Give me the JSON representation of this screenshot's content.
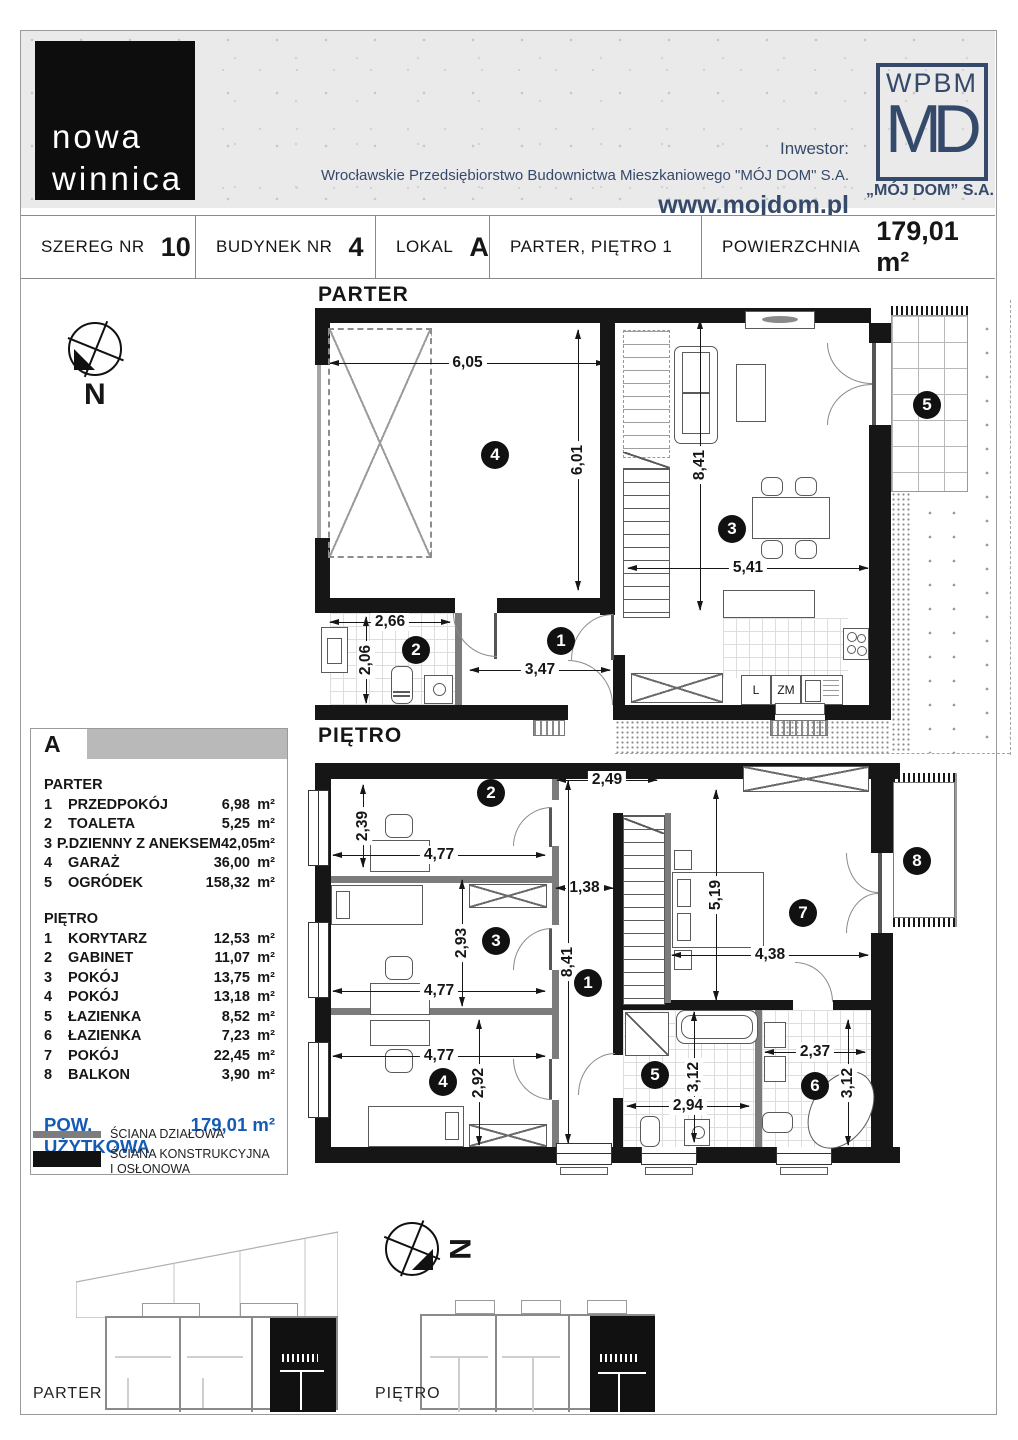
{
  "header": {
    "logo_line1": "nowa",
    "logo_line2": "winnica",
    "investor_label": "Inwestor:",
    "investor_company": "Wrocławskie Przedsiębiorstwo Budownictwa Mieszkaniowego \"MÓJ DOM\" S.A.",
    "website": "www.mojdom.pl",
    "brand_top": "WPBM",
    "brand_main": "MD",
    "brand_caption": "„MÓJ DOM” S.A."
  },
  "info_bar": {
    "cells": [
      {
        "label": "SZEREG NR",
        "value": "10"
      },
      {
        "label": "BUDYNEK NR",
        "value": "4"
      },
      {
        "label": "LOKAL",
        "value": "A"
      },
      {
        "label": "PARTER, PIĘTRO 1",
        "value": ""
      },
      {
        "label": "POWIERZCHNIA",
        "value": "179,01 m²"
      }
    ]
  },
  "compass": {
    "north": "N"
  },
  "plans": {
    "parter": {
      "title": "PARTER",
      "badges": [
        "1",
        "2",
        "3",
        "4",
        "5"
      ],
      "dims": {
        "garage_w": "6,05",
        "garage_h": "6,01",
        "living_h": "8,41",
        "living_w": "5,41",
        "toilet_w": "2,66",
        "toilet_h": "2,06",
        "hall_w": "3,47"
      },
      "kitchen": {
        "fridge": "L",
        "dishwasher": "ZM"
      }
    },
    "pietro": {
      "title": "PIĘTRO",
      "badges": [
        "1",
        "2",
        "3",
        "4",
        "5",
        "6",
        "7",
        "8"
      ],
      "dims": {
        "gabinet_h": "2,39",
        "gabinet_w": "4,77",
        "corridor_top_w": "2,49",
        "corridor_mid_w": "1,38",
        "corridor_h": "8,41",
        "room3_h": "2,93",
        "room3_w": "4,77",
        "room4_w": "4,77",
        "room4_h": "2,92",
        "room7_h": "5,19",
        "room7_w": "4,38",
        "bath5_h": "3,12",
        "bath5_w": "2,94",
        "bath6_w": "2,37",
        "bath6_h": "3,12"
      }
    }
  },
  "legend": {
    "unit": "A",
    "sections": [
      {
        "title": "PARTER",
        "rows": [
          {
            "no": "1",
            "name": "PRZEDPOKÓJ",
            "area": "6,98",
            "unit": "m²"
          },
          {
            "no": "2",
            "name": "TOALETA",
            "area": "5,25",
            "unit": "m²"
          },
          {
            "no": "3",
            "name": "P.DZIENNY Z ANEKSEM",
            "area": "42,05",
            "unit": "m²"
          },
          {
            "no": "4",
            "name": "GARAŻ",
            "area": "36,00",
            "unit": "m²"
          },
          {
            "no": "5",
            "name": "OGRÓDEK",
            "area": "158,32",
            "unit": "m²"
          }
        ]
      },
      {
        "title": "PIĘTRO",
        "rows": [
          {
            "no": "1",
            "name": "KORYTARZ",
            "area": "12,53",
            "unit": "m²"
          },
          {
            "no": "2",
            "name": "GABINET",
            "area": "11,07",
            "unit": "m²"
          },
          {
            "no": "3",
            "name": "POKÓJ",
            "area": "13,75",
            "unit": "m²"
          },
          {
            "no": "4",
            "name": "POKÓJ",
            "area": "13,18",
            "unit": "m²"
          },
          {
            "no": "5",
            "name": "ŁAZIENKA",
            "area": "8,52",
            "unit": "m²"
          },
          {
            "no": "6",
            "name": "ŁAZIENKA",
            "area": "7,23",
            "unit": "m²"
          },
          {
            "no": "7",
            "name": "POKÓJ",
            "area": "22,45",
            "unit": "m²"
          },
          {
            "no": "8",
            "name": "BALKON",
            "area": "3,90",
            "unit": "m²"
          }
        ]
      }
    ],
    "total_label": "POW. UŻYTKOWA",
    "total_value": "179,01 m²",
    "wall_legend": [
      {
        "label": "ŚCIANA DZIAŁOWA"
      },
      {
        "label": "ŚCIANA KONSTRUKCYJNA I OSŁONOWA"
      }
    ]
  },
  "overview": {
    "parter_label": "PARTER",
    "pietro_label": "PIĘTRO",
    "north": "N"
  },
  "colors": {
    "navy": "#35496b",
    "accent_blue": "#155bb5",
    "wall_black": "#161616"
  }
}
